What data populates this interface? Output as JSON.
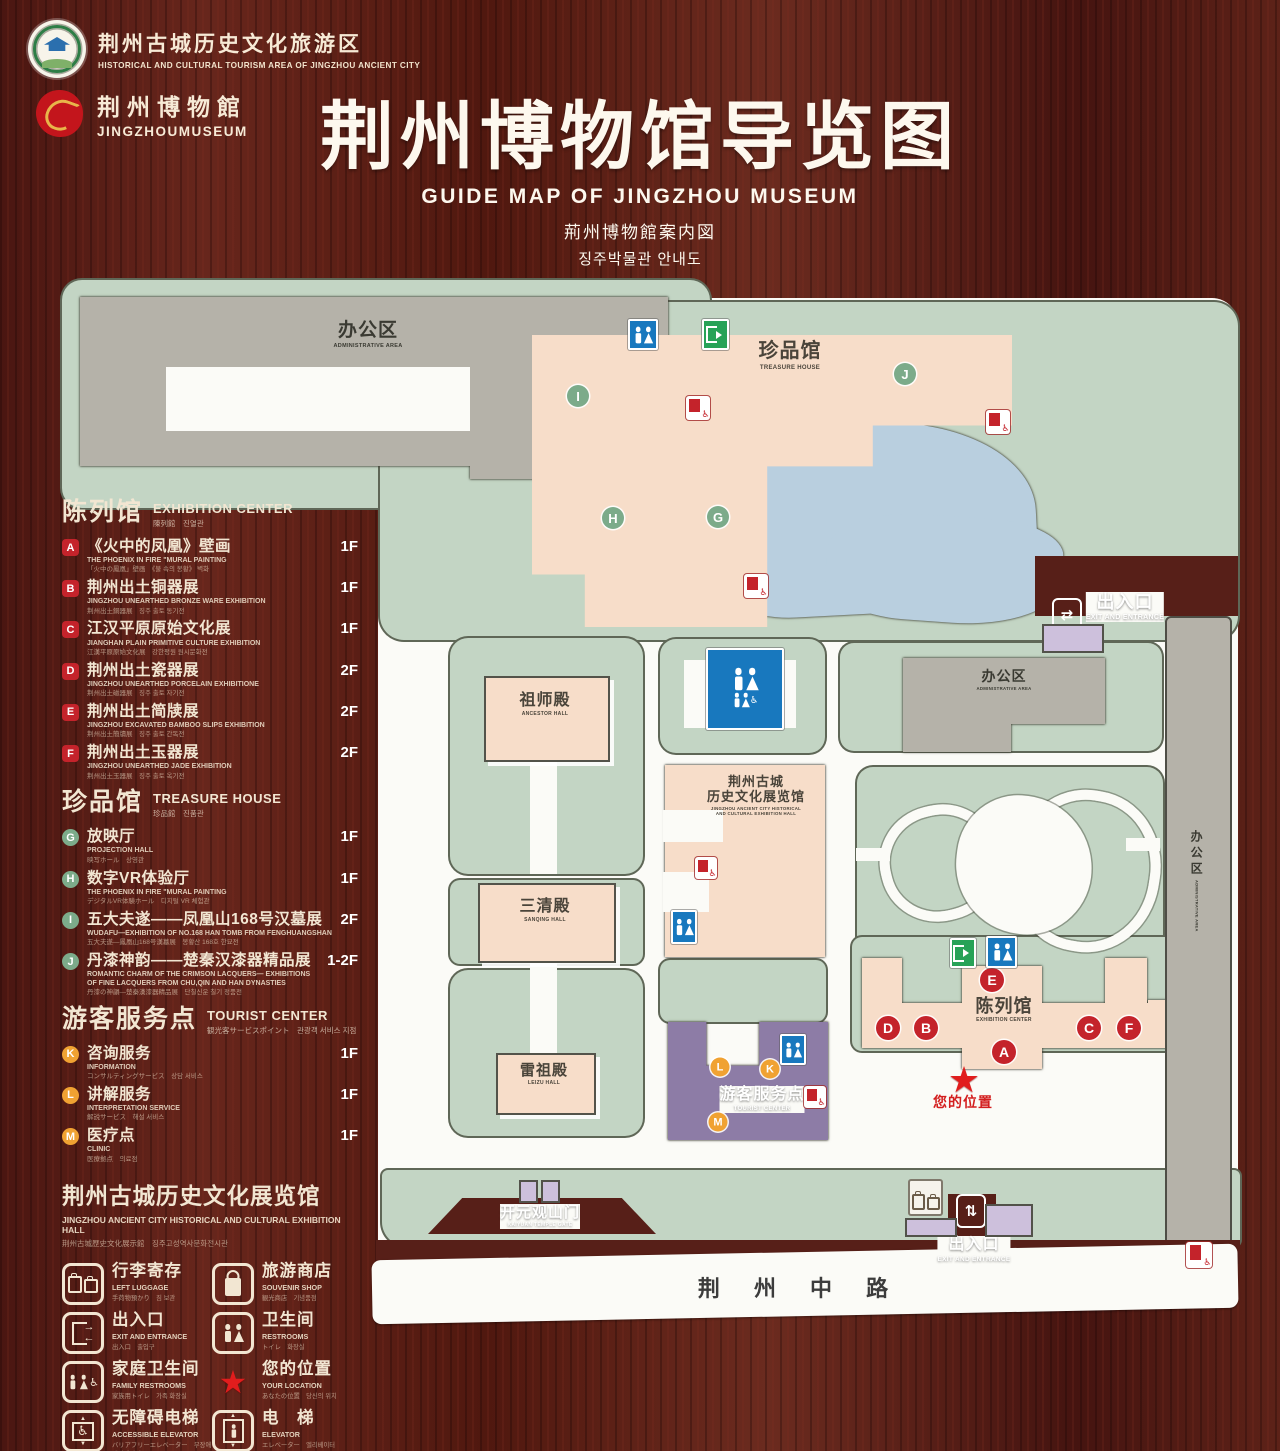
{
  "header": {
    "logo1": {
      "zh": "荆州古城历史文化旅游区",
      "en": "HISTORICAL AND CULTURAL TOURISM AREA OF JINGZHOU ANCIENT CITY"
    },
    "logo2": {
      "zh": "荆州博物館",
      "en": "JINGZHOUMUSEUM"
    },
    "title": {
      "zh": "荆州博物馆导览图",
      "en": "GUIDE MAP OF JINGZHOU MUSEUM",
      "ja": "荊州博物館案内図",
      "ko": "징주박물관 안내도"
    }
  },
  "legend": {
    "sections": [
      {
        "id": "exhibition-center",
        "zh": "陈列馆",
        "en": "EXHIBITION CENTER",
        "sub": "陳列館　진열관",
        "badge": "sq",
        "items": [
          {
            "letter": "A",
            "zh": "《火中的凤凰》壁画",
            "en": "THE PHOENIX IN FIRE \"MURAL PAINTING",
            "sub": "「火中の鳳凰」壁画　《불 속의 봉황》 벽화",
            "floor": "1F"
          },
          {
            "letter": "B",
            "zh": "荆州出土铜器展",
            "en": "JINGZHOU UNEARTHED BRONZE WARE EXHIBITION",
            "sub": "荆州出土銅器展　징주 출토 동기전",
            "floor": "1F"
          },
          {
            "letter": "C",
            "zh": "江汉平原原始文化展",
            "en": "JIANGHAN PLAIN PRIMITIVE CULTURE EXHIBITION",
            "sub": "江漢平原原始文化展　강한평원 원시문화전",
            "floor": "1F"
          },
          {
            "letter": "D",
            "zh": "荆州出土瓷器展",
            "en": "JINGZHOU UNEARTHED PORCELAIN EXHIBITIONE",
            "sub": "荆州出土磁器展　징주 출토 자기전",
            "floor": "2F"
          },
          {
            "letter": "E",
            "zh": "荆州出土简牍展",
            "en": "JINGZHOU EXCAVATED BAMBOO SLIPS EXHIBITION",
            "sub": "荆州出土簡牘展　징주 출토 간독전",
            "floor": "2F"
          },
          {
            "letter": "F",
            "zh": "荆州出土玉器展",
            "en": "JINGZHOU UNEARTHED JADE EXHIBITION",
            "sub": "荆州出土玉器展　징주 출토 옥기전",
            "floor": "2F"
          }
        ]
      },
      {
        "id": "treasure-house",
        "zh": "珍品馆",
        "en": "TREASURE HOUSE",
        "sub": "珍品館　진품관",
        "badge": "cg",
        "items": [
          {
            "letter": "G",
            "zh": "放映厅",
            "en": "PROJECTION HALL",
            "sub": "映写ホール　상영관",
            "floor": "1F"
          },
          {
            "letter": "H",
            "zh": "数字VR体验厅",
            "en": "THE PHOENIX IN FIRE \"MURAL PAINTING",
            "sub": "デジタルVR体験ホール　디지털 VR 체험관",
            "floor": "1F"
          },
          {
            "letter": "I",
            "zh": "五大夫遂——凤凰山168号汉墓展",
            "en": "WUDAFU—EXHIBITION OF NO.168 HAN TOMB FROM FENGHUANGSHAN",
            "sub": "五大夫遂—鳳凰山168号漢墓展　봉황산 168호 한묘전",
            "floor": "2F"
          },
          {
            "letter": "J",
            "zh": "丹漆神韵——楚秦汉漆器精品展",
            "en": "ROMANTIC CHARM OF THE CRIMSON LACQUERS— EXHIBITIONS OF FINE LACQUERS FROM CHU,QIN AND HAN DYNASTIES",
            "sub": "丹漆の神韻—楚秦漢漆器精品展　단칠신운 칠기 정품전",
            "floor": "1-2F"
          }
        ]
      },
      {
        "id": "tourist-center",
        "zh": "游客服务点",
        "en": "TOURIST CENTER",
        "sub": "観光客サービスポイント　관광객 서비스 지점",
        "badge": "co",
        "items": [
          {
            "letter": "K",
            "zh": "咨询服务",
            "en": "INFORMATION",
            "sub": "コンサルティングサービス　상담 서비스",
            "floor": "1F"
          },
          {
            "letter": "L",
            "zh": "讲解服务",
            "en": "INTERPRETATION SERVICE",
            "sub": "解説サービス　해설 서비스",
            "floor": "1F"
          },
          {
            "letter": "M",
            "zh": "医疗点",
            "en": "CLINIC",
            "sub": "医療拠点　의료점",
            "floor": "1F"
          }
        ]
      }
    ],
    "hall_note": {
      "zh": "荆州古城历史文化展览馆",
      "en": "JINGZHOU ANCIENT CITY HISTORICAL AND CULTURAL EXHIBITION HALL",
      "sub": "荆州古城歴史文化展示館　징주고성역사문화전시관"
    },
    "facilities": [
      {
        "icon": "left-luggage",
        "zh": "行李寄存",
        "en": "LEFT LUGGAGE",
        "sub": "手荷物預かり　짐 보관"
      },
      {
        "icon": "souvenir-shop",
        "zh": "旅游商店",
        "en": "SOUVENIR SHOP",
        "sub": "観光商店　기념품점"
      },
      {
        "icon": "exit-entrance",
        "zh": "出入口",
        "en": "EXIT AND ENTRANCE",
        "sub": "出入口　출입구"
      },
      {
        "icon": "restrooms",
        "zh": "卫生间",
        "en": "RESTROOMS",
        "sub": "トイレ　화장실"
      },
      {
        "icon": "family-restrooms",
        "zh": "家庭卫生间",
        "en": "FAMILY RESTROOMS",
        "sub": "家族用トイレ　가족 화장실"
      },
      {
        "icon": "your-location",
        "zh": "您的位置",
        "en": "YOUR LOCATION",
        "sub": "あなたの位置　당신의 위치"
      },
      {
        "icon": "accessible-elevator",
        "zh": "无障碍电梯",
        "en": "ACCESSIBLE ELEVATOR",
        "sub": "バリアフリーエレベーター　무장애 엘리베이터"
      },
      {
        "icon": "elevator",
        "zh": "电　梯",
        "en": "ELEVATOR",
        "sub": "エレベーター　엘리베이터"
      },
      {
        "icon": "display-area",
        "zh": "展示区域",
        "en": "DISPLAY AREA",
        "sub": "展示エリア　전시 구역"
      },
      {
        "icon": "office-area",
        "zh": "办公区域",
        "en": "OFFICE AREA",
        "sub": "オフィスエリア　사무 구역"
      }
    ]
  },
  "map": {
    "labels": [
      {
        "id": "admin-area-topleft",
        "x": 368,
        "y": 320,
        "zh": "办公区",
        "en": "ADMINISTRATIVE AREA",
        "cls": "dark",
        "zs": 19,
        "es": 5.5
      },
      {
        "id": "treasure-house",
        "x": 790,
        "y": 340,
        "zh": "珍品馆",
        "en": "TREASURE HOUSE",
        "cls": "brown",
        "zs": 20,
        "es": 6
      },
      {
        "id": "ancestor-hall",
        "x": 545,
        "y": 692,
        "zh": "祖师殿",
        "en": "ANCESTOR HALL",
        "cls": "brown",
        "zs": 16,
        "es": 5
      },
      {
        "id": "sanqing-hall",
        "x": 545,
        "y": 898,
        "zh": "三清殿",
        "en": "SANQING HALL",
        "cls": "brown",
        "zs": 16,
        "es": 5
      },
      {
        "id": "leizu-hall",
        "x": 544,
        "y": 1062,
        "zh": "雷祖殿",
        "en": "LEIZU HALL",
        "cls": "brown",
        "zs": 15,
        "es": 5
      },
      {
        "id": "jingzhou-exhibition-hall",
        "x": 756,
        "y": 774,
        "zh": "荆州古城\n历史文化展览馆",
        "en": "JINGZHOU ANCIENT CITY HISTORICAL\nAND CULTURAL EXHIBITION HALL",
        "cls": "brown",
        "zs": 13,
        "es": 4.3
      },
      {
        "id": "tourist-center",
        "x": 762,
        "y": 1086,
        "zh": "游客服务点",
        "en": "TOURIST CENTER",
        "cls": "white",
        "zs": 16,
        "es": 6
      },
      {
        "id": "exhibition-center",
        "x": 1004,
        "y": 996,
        "zh": "陈列馆",
        "en": "EXHIBITION CENTER",
        "cls": "brown",
        "zs": 18,
        "es": 5
      },
      {
        "id": "admin-area-right",
        "x": 1004,
        "y": 668,
        "zh": "办公区",
        "en": "ADMINISTRATIVE AREA",
        "cls": "dark",
        "zs": 14,
        "es": 4.3
      },
      {
        "id": "admin-area-strip",
        "x": 1196,
        "y": 830,
        "zh": "办公区",
        "en": "ADMINISTRATIVE AREA",
        "cls": "dark vert",
        "zs": 12,
        "es": 4
      },
      {
        "id": "exit-top-right",
        "x": 1125,
        "y": 592,
        "zh": "出入口",
        "en": "EXIT AND ENTRANCE",
        "cls": "white",
        "zs": 18,
        "es": 7
      },
      {
        "id": "exit-bottom",
        "x": 974,
        "y": 1236,
        "zh": "出入口",
        "en": "EXIT AND ENTRANCE",
        "cls": "white",
        "zs": 16,
        "es": 6.5
      },
      {
        "id": "kaiyuan-gate",
        "x": 540,
        "y": 1204,
        "zh": "开元观山门",
        "en": "KAIYUAN TEMPLE GATE",
        "cls": "white",
        "zs": 15,
        "es": 5
      },
      {
        "id": "your-location",
        "x": 963,
        "y": 1094,
        "zh": "您的位置",
        "en": "",
        "cls": "red",
        "zs": 14,
        "es": 0
      },
      {
        "id": "road",
        "x": 800,
        "y": 1276,
        "zh": "荆 州 中 路",
        "en": "",
        "cls": "road-t",
        "zs": 22,
        "es": 0,
        "ls": 14
      }
    ],
    "markers": [
      {
        "letter": "A",
        "color": "red",
        "x": 1004,
        "y": 1052
      },
      {
        "letter": "B",
        "color": "red",
        "x": 926,
        "y": 1028
      },
      {
        "letter": "C",
        "color": "red",
        "x": 1089,
        "y": 1028
      },
      {
        "letter": "D",
        "color": "red",
        "x": 888,
        "y": 1028
      },
      {
        "letter": "E",
        "color": "red",
        "x": 992,
        "y": 980
      },
      {
        "letter": "F",
        "color": "red",
        "x": 1129,
        "y": 1028
      },
      {
        "letter": "G",
        "color": "green",
        "x": 718,
        "y": 517
      },
      {
        "letter": "H",
        "color": "green",
        "x": 613,
        "y": 518
      },
      {
        "letter": "I",
        "color": "green",
        "x": 578,
        "y": 396
      },
      {
        "letter": "J",
        "color": "green",
        "x": 905,
        "y": 374
      },
      {
        "letter": "K",
        "color": "orange",
        "x": 770,
        "y": 1069
      },
      {
        "letter": "L",
        "color": "orange",
        "x": 720,
        "y": 1067
      },
      {
        "letter": "M",
        "color": "orange",
        "x": 718,
        "y": 1122
      }
    ],
    "icons": [
      {
        "t": "wc",
        "x": 628,
        "y": 321,
        "w": 30,
        "h": 27
      },
      {
        "t": "exitg",
        "x": 702,
        "y": 321,
        "w": 27,
        "h": 27
      },
      {
        "t": "wcfam",
        "x": 706,
        "y": 650,
        "w": 78,
        "h": 78
      },
      {
        "t": "wc",
        "x": 671,
        "y": 912,
        "w": 26,
        "h": 30
      },
      {
        "t": "wc",
        "x": 781,
        "y": 1036,
        "w": 23,
        "h": 27
      },
      {
        "t": "wc",
        "x": 986,
        "y": 938,
        "w": 31,
        "h": 28
      },
      {
        "t": "exitg",
        "x": 950,
        "y": 940,
        "w": 26,
        "h": 26
      },
      {
        "t": "acc",
        "x": 686,
        "y": 396,
        "w": 24,
        "h": 24
      },
      {
        "t": "acc",
        "x": 986,
        "y": 410,
        "w": 24,
        "h": 24
      },
      {
        "t": "acc",
        "x": 744,
        "y": 574,
        "w": 24,
        "h": 24
      },
      {
        "t": "acc",
        "x": 695,
        "y": 857,
        "w": 22,
        "h": 22
      },
      {
        "t": "acc",
        "x": 804,
        "y": 1086,
        "w": 22,
        "h": 22
      },
      {
        "t": "acc",
        "x": 1186,
        "y": 1242,
        "w": 26,
        "h": 26
      },
      {
        "t": "star",
        "x": 946,
        "y": 1062,
        "w": 36,
        "h": 36
      },
      {
        "t": "exitw",
        "x": 1052,
        "y": 600,
        "w": 30,
        "h": 30,
        "g": "⇄"
      },
      {
        "t": "exitw",
        "x": 956,
        "y": 1196,
        "w": 30,
        "h": 30,
        "g": "⇅"
      },
      {
        "t": "lug",
        "x": 908,
        "y": 1179,
        "w": 35,
        "h": 37
      },
      {
        "t": "prect",
        "x": 519,
        "y": 1180,
        "w": 19,
        "h": 23
      },
      {
        "t": "prect",
        "x": 541,
        "y": 1180,
        "w": 19,
        "h": 23
      },
      {
        "t": "prect",
        "x": 1042,
        "y": 624,
        "w": 62,
        "h": 29
      },
      {
        "t": "prect",
        "x": 905,
        "y": 1218,
        "w": 52,
        "h": 19
      },
      {
        "t": "prect",
        "x": 985,
        "y": 1204,
        "w": 48,
        "h": 33
      }
    ],
    "colors": {
      "lawn": "#c3d5c4",
      "pond": "#b9cfdf",
      "display": "#f7ddc9",
      "office": "#b5b2a9",
      "visitor_center": "#8d7ca6",
      "marker_red": "#c4232b",
      "marker_green": "#7cab8a",
      "marker_orange": "#f0a232",
      "restroom_blue": "#1878be",
      "exit_green": "#27a257",
      "location_red": "#e11d1d",
      "wood": "#571f18"
    }
  }
}
